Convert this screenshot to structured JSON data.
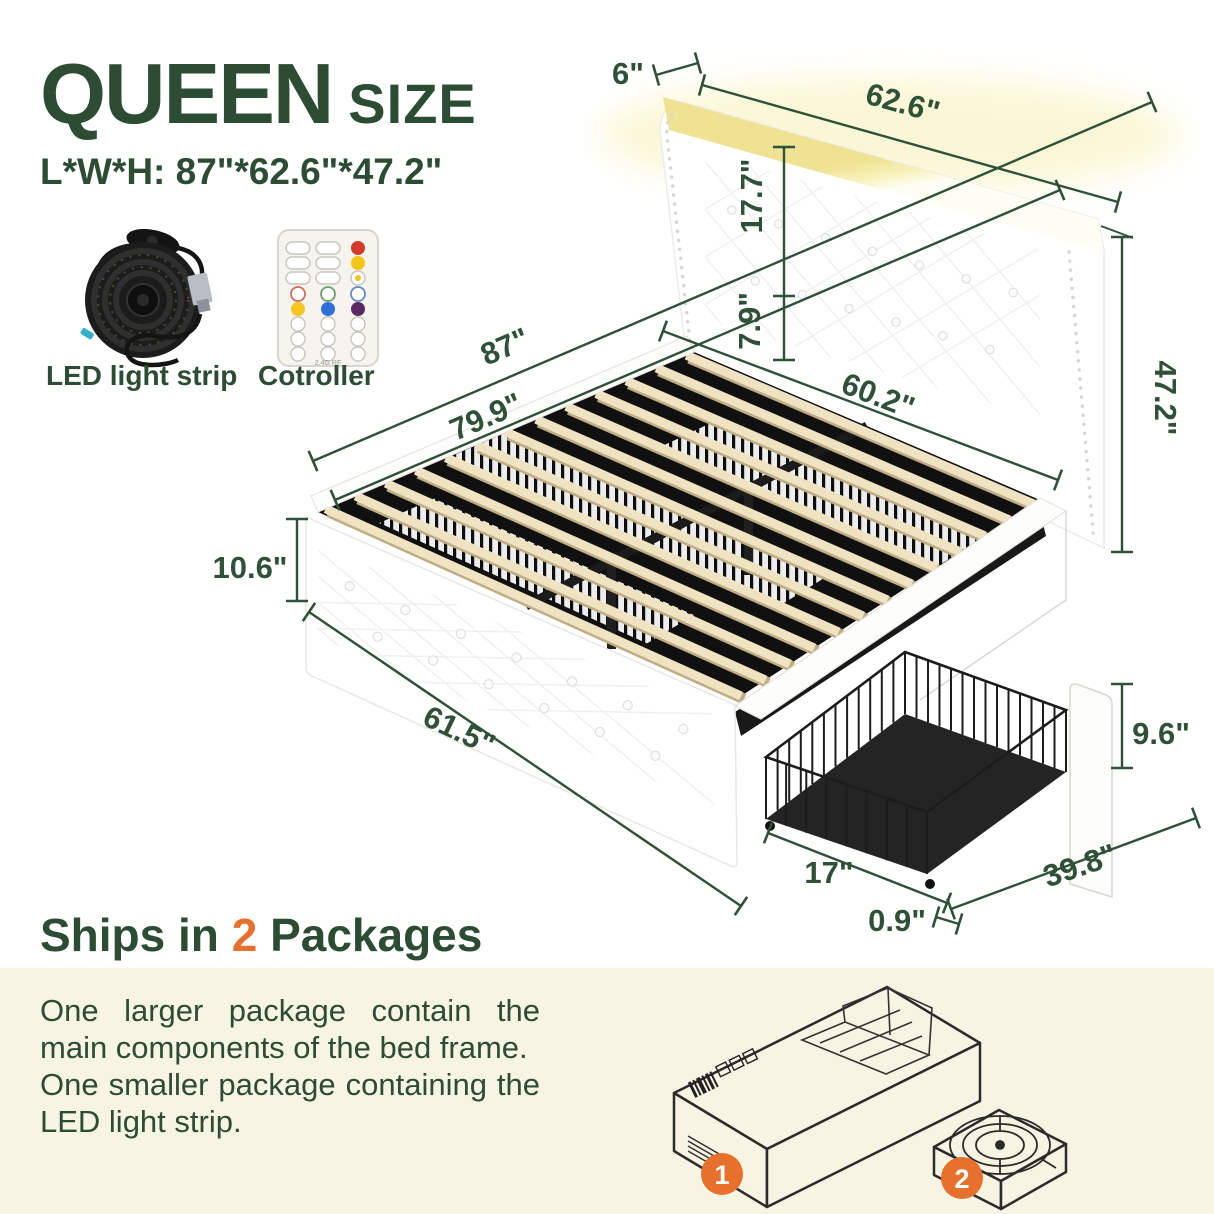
{
  "title": {
    "main": "QUEEN",
    "sub": "SIZE",
    "lwh": "L*W*H: 87\"*62.6\"*47.2\""
  },
  "accessories": {
    "led": "LED light strip",
    "controller": "Cotroller",
    "controller_small_text": "2.4G RF"
  },
  "dimensions": {
    "top_depth": "6\"",
    "top_width": "62.6\"",
    "headboard_upper": "17.7\"",
    "headboard_lower": "7.9\"",
    "total_length": "87\"",
    "slat_length": "79.9\"",
    "inner_width": "60.2\"",
    "total_height": "47.2\"",
    "footboard_height": "10.6\"",
    "footboard_width": "61.5\"",
    "drawer_front_height": "9.6\"",
    "drawer_basket_depth": "17\"",
    "drawer_width": "39.8\"",
    "drawer_panel_thickness": "0.9\""
  },
  "shipping": {
    "prefix": "Ships in",
    "count": "2",
    "suffix": "Packages",
    "paragraph1": "One larger package contain the main components of the bed frame.",
    "paragraph2": "One smaller package containing the LED light strip.",
    "package1_number": "1",
    "package2_number": "2"
  },
  "colors": {
    "green": "#2c4c34",
    "dim_green": "#2e5138",
    "orange": "#e8702d",
    "beige": "#f8f4e3",
    "led_glow": "#f2e88f",
    "slat": "#efe3c1"
  }
}
